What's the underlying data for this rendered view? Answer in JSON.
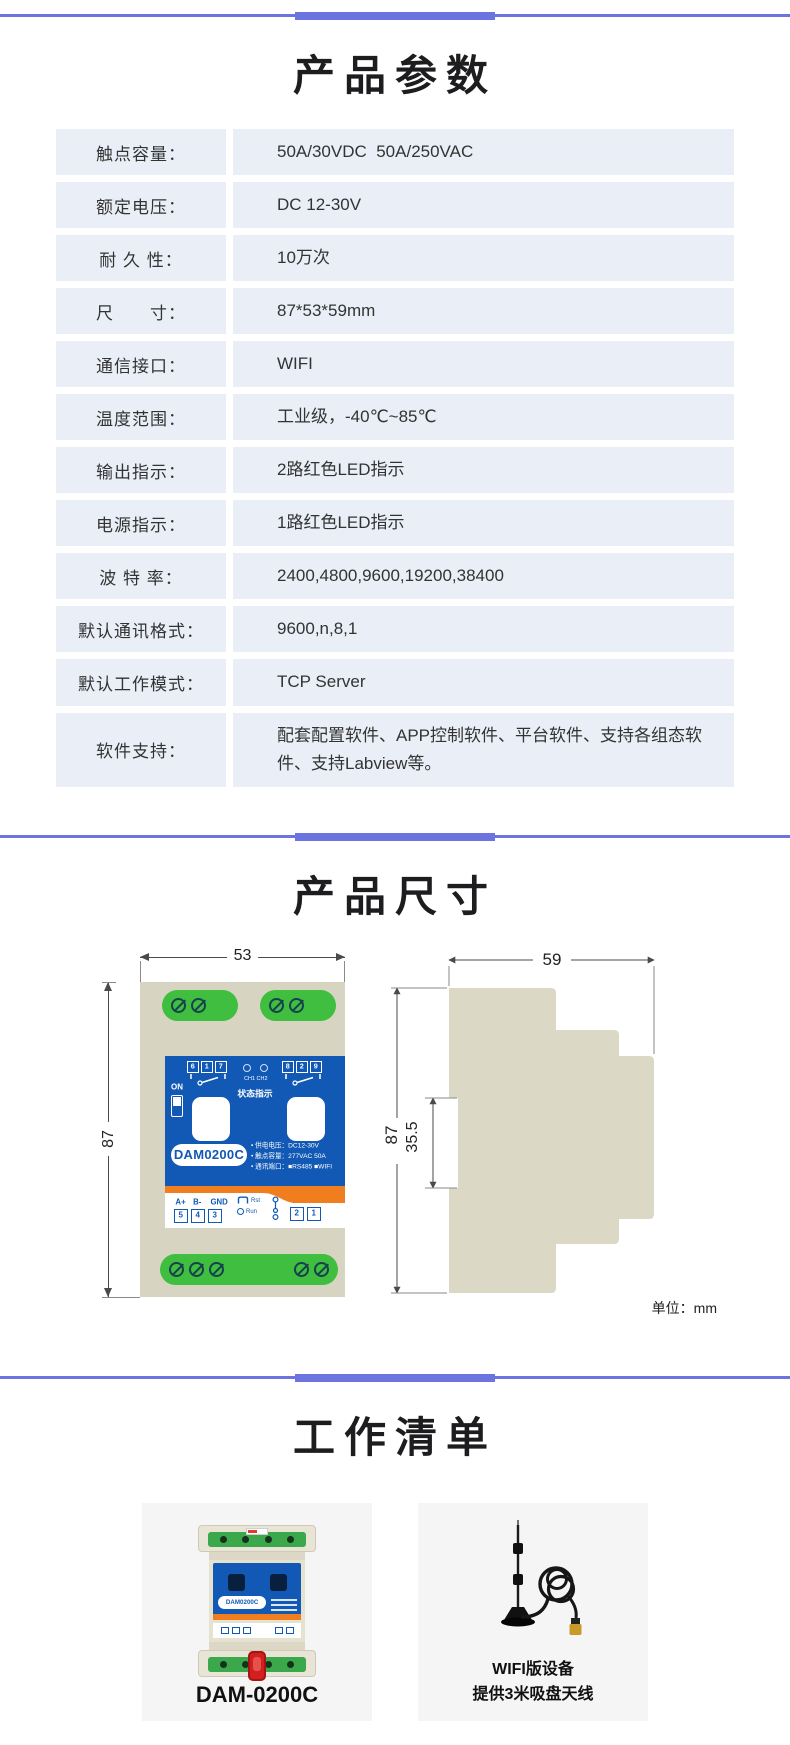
{
  "colors": {
    "accent": "#6b74df",
    "cell-bg": "#e9eef7",
    "device-blue": "#1159b4",
    "device-orange": "#f07d1e",
    "device-green": "#3fbe3f",
    "device-beige": "#d8d4c2",
    "card-bg": "#f5f5f5"
  },
  "params": {
    "title": "产品参数",
    "rows": [
      {
        "label": "触点容量：",
        "value": "50A/30VDC  50A/250VAC"
      },
      {
        "label": "额定电压：",
        "value": "DC 12-30V"
      },
      {
        "label": "耐 久 性：",
        "value": "10万次"
      },
      {
        "label": "尺　　寸：",
        "value": "87*53*59mm"
      },
      {
        "label": "通信接口：",
        "value": "WIFI"
      },
      {
        "label": "温度范围：",
        "value": "工业级，-40℃~85℃"
      },
      {
        "label": "输出指示：",
        "value": "2路红色LED指示"
      },
      {
        "label": "电源指示：",
        "value": "1路红色LED指示"
      },
      {
        "label": "波 特 率：",
        "value": "2400,4800,9600,19200,38400"
      },
      {
        "label": "默认通讯格式：",
        "value": "9600,n,8,1"
      },
      {
        "label": "默认工作模式：",
        "value": "TCP Server"
      },
      {
        "label": "软件支持：",
        "value": "配套配置软件、APP控制软件、平台软件、支持各组态软件、支持Labview等。"
      }
    ]
  },
  "dimensions": {
    "title": "产品尺寸",
    "unit_note": "单位：mm",
    "front": {
      "width_label": "53",
      "height_label": "87",
      "on_label": "ON",
      "relay1_terminals": [
        "6",
        "1",
        "7"
      ],
      "relay2_terminals": [
        "8",
        "2",
        "9"
      ],
      "ch_labels": "CH1  CH2",
      "status_label": "状态指示",
      "model": "DAM0200C",
      "spec_lines": [
        "• 供电电压：DC12-30V",
        "• 触点容量：277VAC 50A",
        "• 通讯端口：■RS485 ■WIFI"
      ],
      "io_labels": [
        "A+",
        "B-",
        "GND"
      ],
      "io_terminals": [
        "5",
        "4",
        "3"
      ],
      "rst_label": "Rst",
      "run_label": "Run",
      "plus_label": "+",
      "minus_label": "-",
      "power_terminals": [
        "2",
        "1"
      ]
    },
    "side": {
      "width_label": "59",
      "height_label": "87",
      "notch_label": "35.5"
    }
  },
  "worklist": {
    "title": "工作清单",
    "items": [
      {
        "caption": "DAM-0200C",
        "model_label": "DAM0200C"
      },
      {
        "caption_line1": "WIFI版设备",
        "caption_line2": "提供3米吸盘天线"
      }
    ]
  }
}
